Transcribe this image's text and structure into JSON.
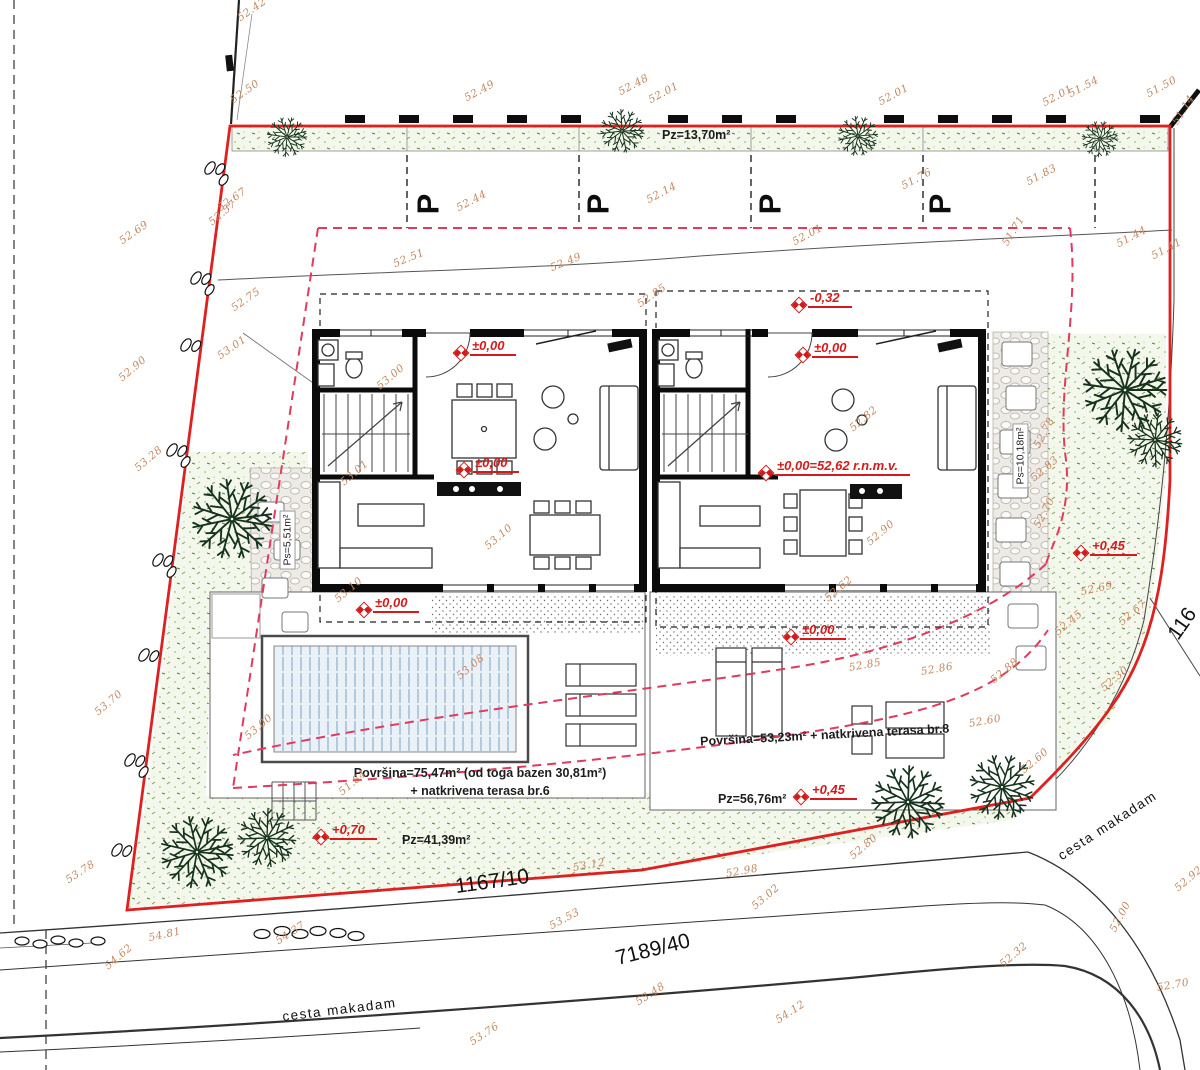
{
  "plan": {
    "green_strip_area": "Pz=13,70m²",
    "parking_symbol": "P",
    "left_house": {
      "terrace_area_line1": "Površina=75,47m² (od toga bazen 30,81m²)",
      "terrace_area_line2": "+ natkrivena terasa br.6",
      "lawn_area": "Pz=41,39m²",
      "path_area": "Ps=5,51m²"
    },
    "right_house": {
      "terrace_area": "Površina=53,23m² + natkrivena terasa br.8",
      "lawn_area": "Pz=56,76m²",
      "path_area": "Ps=10,18m²"
    },
    "parcels": {
      "front_road": "1167/10",
      "main_road": "7189/40",
      "side": "116"
    },
    "road_left": "cesta makadam",
    "road_right": "cesta makadam",
    "colors": {
      "boundary": "#e01f1f",
      "setback_dashed": "#e23a5e",
      "level_red": "#d41a1a",
      "elevation_tan": "#c4875f",
      "tree_green": "#16331d",
      "water_blue": "#94b4d2"
    }
  },
  "level_markers": [
    {
      "text": "±0,00",
      "x": 455,
      "y": 338
    },
    {
      "text": "-0,32",
      "x": 793,
      "y": 290
    },
    {
      "text": "±0,00",
      "x": 797,
      "y": 340
    },
    {
      "text": "±0,00",
      "x": 458,
      "y": 455
    },
    {
      "text": "±0,00=52,62 r.n.m.v.",
      "x": 760,
      "y": 458
    },
    {
      "text": "±0,00",
      "x": 358,
      "y": 595
    },
    {
      "text": "±0,00",
      "x": 785,
      "y": 622
    },
    {
      "text": "+0,45",
      "x": 1075,
      "y": 538
    },
    {
      "text": "+0,70",
      "x": 315,
      "y": 822
    },
    {
      "text": "+0,45",
      "x": 795,
      "y": 782
    }
  ],
  "parking_stalls": [
    {
      "x": 418,
      "y": 186
    },
    {
      "x": 588,
      "y": 186
    },
    {
      "x": 760,
      "y": 186
    },
    {
      "x": 930,
      "y": 186
    }
  ],
  "elevations": [
    {
      "t": "52.42",
      "x": 242,
      "y": 12,
      "r": -35
    },
    {
      "t": "52.50",
      "x": 235,
      "y": 94,
      "r": -35
    },
    {
      "t": "52.49",
      "x": 468,
      "y": 92,
      "r": -28
    },
    {
      "t": "52.48",
      "x": 622,
      "y": 86,
      "r": -28
    },
    {
      "t": "52.01",
      "x": 652,
      "y": 94,
      "r": -28
    },
    {
      "t": "52.01",
      "x": 882,
      "y": 96,
      "r": -28
    },
    {
      "t": "52.01",
      "x": 1046,
      "y": 97,
      "r": -28
    },
    {
      "t": "51.54",
      "x": 1072,
      "y": 88,
      "r": -28
    },
    {
      "t": "51.50",
      "x": 1150,
      "y": 88,
      "r": -28
    },
    {
      "t": "51.14",
      "x": 1180,
      "y": 115,
      "r": -58
    },
    {
      "t": "52.67",
      "x": 222,
      "y": 202,
      "r": -35
    },
    {
      "t": "52.57",
      "x": 214,
      "y": 216,
      "r": -40
    },
    {
      "t": "52.69",
      "x": 124,
      "y": 235,
      "r": -35
    },
    {
      "t": "52.44",
      "x": 460,
      "y": 202,
      "r": -28
    },
    {
      "t": "52.14",
      "x": 650,
      "y": 194,
      "r": -28
    },
    {
      "t": "51.76",
      "x": 905,
      "y": 180,
      "r": -28
    },
    {
      "t": "51.83",
      "x": 1030,
      "y": 176,
      "r": -28
    },
    {
      "t": "52.01",
      "x": 796,
      "y": 236,
      "r": -28
    },
    {
      "t": "51.71",
      "x": 1010,
      "y": 236,
      "r": -58
    },
    {
      "t": "51.44",
      "x": 1120,
      "y": 238,
      "r": -28
    },
    {
      "t": "51.41",
      "x": 1155,
      "y": 250,
      "r": -28
    },
    {
      "t": "52.51",
      "x": 396,
      "y": 258,
      "r": -22
    },
    {
      "t": "52.49",
      "x": 553,
      "y": 262,
      "r": -22
    },
    {
      "t": "52.85",
      "x": 642,
      "y": 298,
      "r": -35
    },
    {
      "t": "52.75",
      "x": 236,
      "y": 302,
      "r": -35
    },
    {
      "t": "52.90",
      "x": 124,
      "y": 372,
      "r": -40
    },
    {
      "t": "53.01",
      "x": 222,
      "y": 350,
      "r": -35
    },
    {
      "t": "53.28",
      "x": 140,
      "y": 462,
      "r": -40
    },
    {
      "t": "53.00",
      "x": 382,
      "y": 380,
      "r": -40
    },
    {
      "t": "53.01",
      "x": 346,
      "y": 476,
      "r": -40
    },
    {
      "t": "53.10",
      "x": 340,
      "y": 593,
      "r": -40
    },
    {
      "t": "53.10",
      "x": 490,
      "y": 540,
      "r": -40
    },
    {
      "t": "53.08",
      "x": 462,
      "y": 670,
      "r": -40
    },
    {
      "t": "53.00",
      "x": 250,
      "y": 730,
      "r": -40
    },
    {
      "t": "51.84",
      "x": 344,
      "y": 786,
      "r": -40
    },
    {
      "t": "52.82",
      "x": 855,
      "y": 422,
      "r": -40
    },
    {
      "t": "52.90",
      "x": 872,
      "y": 536,
      "r": -40
    },
    {
      "t": "52.62",
      "x": 830,
      "y": 592,
      "r": -40
    },
    {
      "t": "52.78",
      "x": 1042,
      "y": 438,
      "r": -62
    },
    {
      "t": "52.83",
      "x": 1036,
      "y": 472,
      "r": -40
    },
    {
      "t": "52.70",
      "x": 1042,
      "y": 518,
      "r": -62
    },
    {
      "t": "52.69",
      "x": 1082,
      "y": 586,
      "r": -12
    },
    {
      "t": "52.67",
      "x": 1124,
      "y": 616,
      "r": -40
    },
    {
      "t": "52.45",
      "x": 1060,
      "y": 626,
      "r": -40
    },
    {
      "t": "52.30",
      "x": 1106,
      "y": 682,
      "r": -40
    },
    {
      "t": "52.85",
      "x": 850,
      "y": 662,
      "r": -10
    },
    {
      "t": "52.86",
      "x": 922,
      "y": 666,
      "r": -10
    },
    {
      "t": "52.88",
      "x": 996,
      "y": 674,
      "r": -40
    },
    {
      "t": "52.60",
      "x": 970,
      "y": 718,
      "r": -10
    },
    {
      "t": "52.60",
      "x": 1026,
      "y": 764,
      "r": -40
    },
    {
      "t": "52.80",
      "x": 855,
      "y": 850,
      "r": -40
    },
    {
      "t": "53.12",
      "x": 574,
      "y": 862,
      "r": -10
    },
    {
      "t": "52.98",
      "x": 727,
      "y": 868,
      "r": -10
    },
    {
      "t": "53.02",
      "x": 757,
      "y": 900,
      "r": -40
    },
    {
      "t": "53.53",
      "x": 553,
      "y": 920,
      "r": -28
    },
    {
      "t": "53.70",
      "x": 100,
      "y": 706,
      "r": -40
    },
    {
      "t": "53.78",
      "x": 70,
      "y": 874,
      "r": -33
    },
    {
      "t": "54.81",
      "x": 150,
      "y": 932,
      "r": -12
    },
    {
      "t": "54.37",
      "x": 280,
      "y": 935,
      "r": -33
    },
    {
      "t": "54.62",
      "x": 110,
      "y": 960,
      "r": -40
    },
    {
      "t": "52.00",
      "x": 1118,
      "y": 922,
      "r": -62
    },
    {
      "t": "52.92",
      "x": 1180,
      "y": 882,
      "r": -40
    },
    {
      "t": "52.70",
      "x": 1158,
      "y": 982,
      "r": -10
    },
    {
      "t": "52.32",
      "x": 1005,
      "y": 958,
      "r": -40
    },
    {
      "t": "53.76",
      "x": 474,
      "y": 1036,
      "r": -33
    },
    {
      "t": "53.48",
      "x": 640,
      "y": 996,
      "r": -33
    },
    {
      "t": "54.12",
      "x": 780,
      "y": 1014,
      "r": -33
    }
  ]
}
